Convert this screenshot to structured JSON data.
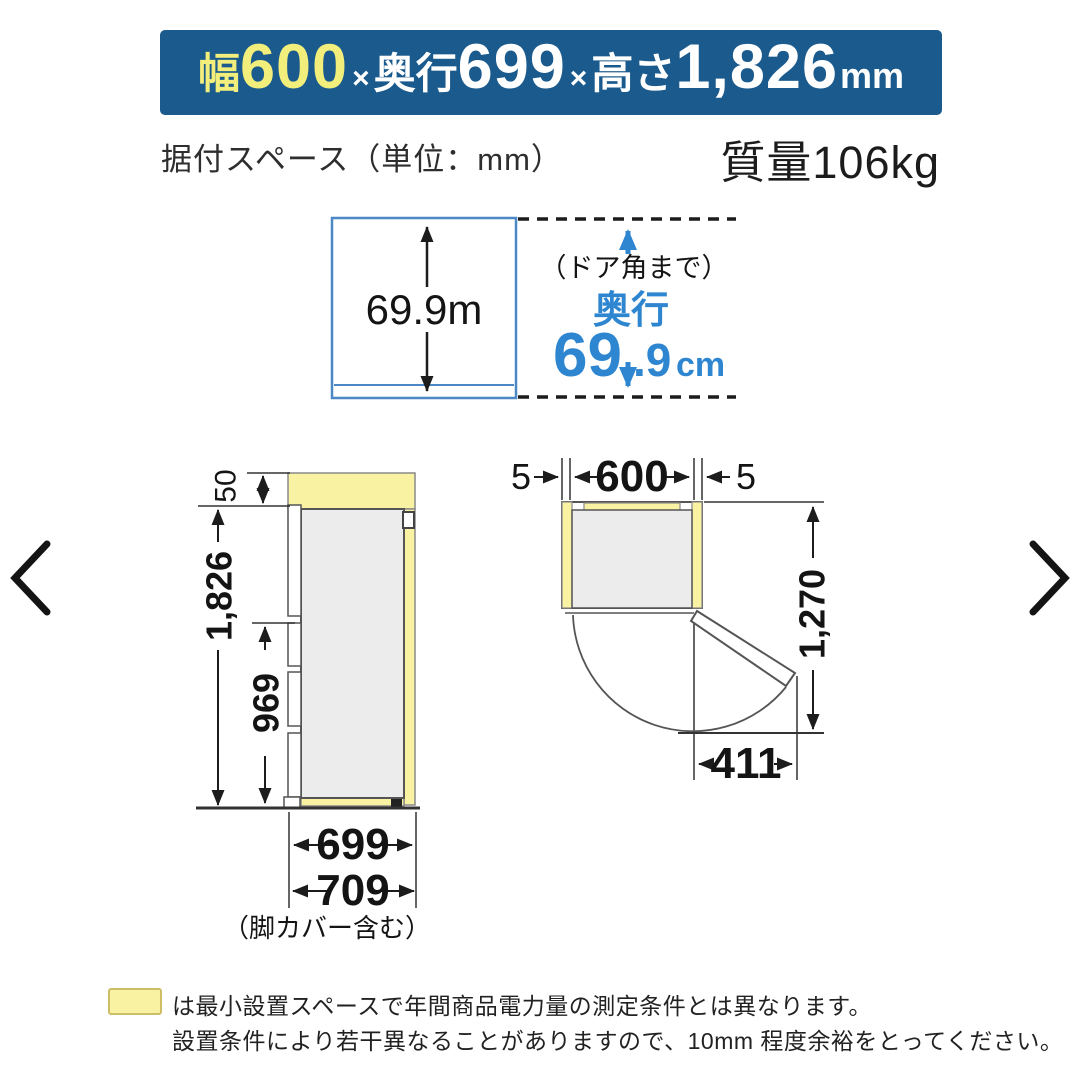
{
  "banner": {
    "width_label": "幅",
    "width_value": "600",
    "times1": "×",
    "depth_label": "奥行",
    "depth_value": "699",
    "times2": "×",
    "height_label": "高さ",
    "height_value": "1,826",
    "unit": "mm"
  },
  "subheader": {
    "install_space": "据付スペース（単位：mm）",
    "mass": "質量106kg"
  },
  "depth_diagram": {
    "inner_depth": "69.9m",
    "door_corner_note": "（ドア角まで）",
    "depth_label": "奥行",
    "depth_big": "69",
    "depth_small": ".9",
    "depth_unit": "cm"
  },
  "side_view": {
    "top_clearance": "50",
    "height": "1,826",
    "lower_height": "969",
    "depth": "699",
    "depth_with_legs": "709",
    "legs_note": "（脚カバー含む）"
  },
  "top_view": {
    "left_clearance": "5",
    "width": "600",
    "right_clearance": "5",
    "swing_depth": "1,270",
    "door_swing_width": "411"
  },
  "footnote": {
    "line1": "は最小設置スペースで年間商品電力量の測定条件とは異なります。",
    "line2": "設置条件により若干異なることがありますので、10mm 程度余裕をとってください。"
  },
  "colors": {
    "banner_bg": "#1a5a8d",
    "banner_highlight": "#f2ee7b",
    "accent_blue": "#2e86d0",
    "diagram_blue": "#4c88c5",
    "clearance_yellow": "#f8f2a2"
  }
}
